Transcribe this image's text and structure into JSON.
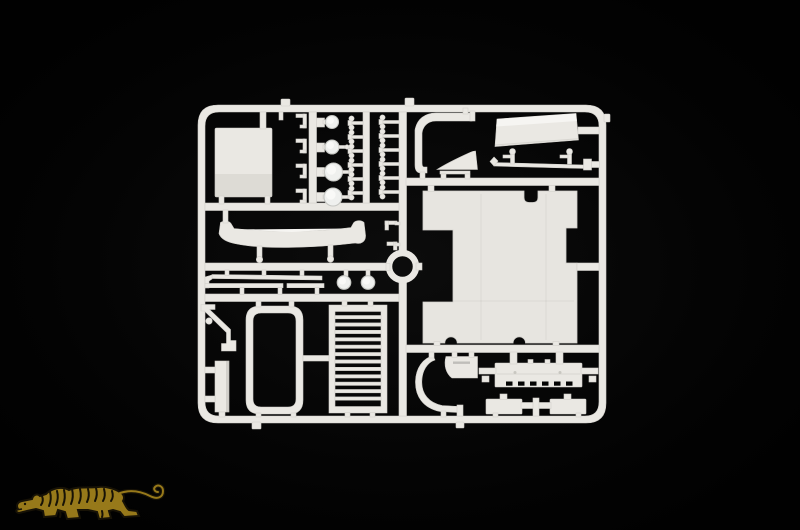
{
  "image": {
    "alt": "Product photo: white injection-moulded plastic model kit sprue with truck cab parts (roof panel, grille, window frame, lenses, clips, bumper, visor, wiper arms, steps) on a black background, with a gold tiger logo watermark in the lower left corner",
    "width": 800,
    "height": 530
  },
  "colors": {
    "bg": "#030303",
    "plastic": "#eae8e3",
    "plastic-bright": "#f6f5f2",
    "plastic-dim": "#c9c7c1",
    "plastic-edge": "#d2d0cb",
    "panel": "#e7e5e0",
    "lens": "#eff0ee",
    "lens-rim": "#c6c7c3",
    "lens-hi": "#f9f9f7",
    "tiger-gold": "#97791a",
    "tiger-dark": "#171206"
  }
}
